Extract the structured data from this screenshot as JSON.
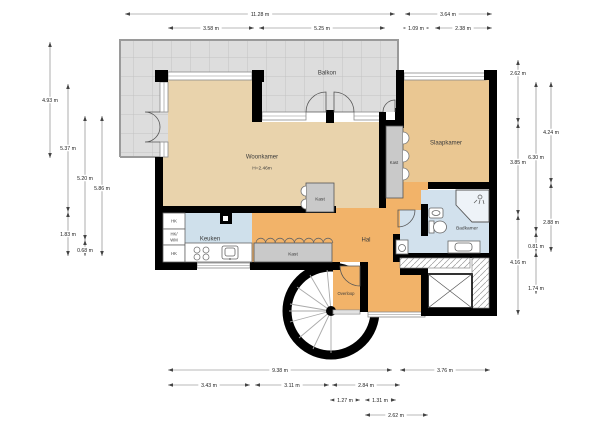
{
  "labels": {
    "balkon": "Balkon",
    "woonkamer": "Woonkamer",
    "woonkamer_height": "H=2.46m",
    "slaapkamer": "Slaapkamer",
    "badkamer": "Badkamer",
    "keuken": "Keuken",
    "hal": "Hal",
    "overloop": "Overloop",
    "kast_center": "Kast",
    "kast_wardrobe": "Kast",
    "kast_bedroom": "Kast",
    "hk_top": "HK",
    "hk_mid_1": "HK/",
    "hk_mid_2": "WM",
    "hk_bottom": "HK"
  },
  "colors": {
    "wall": "#000000",
    "living_room": "#e9d3ac",
    "bedroom": "#eac792",
    "hall": "#f2b369",
    "wet_room": "#d2e1ed",
    "balcony_tile": "#dddddd",
    "closet": "#c9c9c9",
    "dimension_line": "#777777"
  },
  "dimensions": [
    {
      "label": "11.28 m",
      "x1": 125,
      "y1": 14,
      "x2": 395,
      "y2": 14,
      "lx": 260,
      "ly": 14
    },
    {
      "label": "3.64 m",
      "x1": 405,
      "y1": 14,
      "x2": 492,
      "y2": 14,
      "lx": 448,
      "ly": 14
    },
    {
      "label": "3.58 m",
      "x1": 168,
      "y1": 28,
      "x2": 254,
      "y2": 28,
      "lx": 211,
      "ly": 28
    },
    {
      "label": "5.25 m",
      "x1": 259,
      "y1": 28,
      "x2": 385,
      "y2": 28,
      "lx": 322,
      "ly": 28
    },
    {
      "label": "1.09 m",
      "x1": 403,
      "y1": 28,
      "x2": 429,
      "y2": 28,
      "lx": 416,
      "ly": 28
    },
    {
      "label": "2.38 m",
      "x1": 435,
      "y1": 28,
      "x2": 492,
      "y2": 28,
      "lx": 463,
      "ly": 28
    },
    {
      "label": "4.93 m",
      "x1": 50,
      "y1": 42,
      "x2": 50,
      "y2": 158,
      "lx": 50,
      "ly": 100
    },
    {
      "label": "5.37 m",
      "x1": 68,
      "y1": 84,
      "x2": 68,
      "y2": 212,
      "lx": 68,
      "ly": 148
    },
    {
      "label": "1.83 m",
      "x1": 68,
      "y1": 212,
      "x2": 68,
      "y2": 256,
      "lx": 68,
      "ly": 234
    },
    {
      "label": "5.20 m",
      "x1": 85,
      "y1": 116,
      "x2": 85,
      "y2": 240,
      "lx": 85,
      "ly": 178
    },
    {
      "label": "0.68 m",
      "x1": 85,
      "y1": 240,
      "x2": 85,
      "y2": 256,
      "lx": 85,
      "ly": 250
    },
    {
      "label": "5.86 m",
      "x1": 102,
      "y1": 116,
      "x2": 102,
      "y2": 256,
      "lx": 102,
      "ly": 188
    },
    {
      "label": "2.62 m",
      "x1": 518,
      "y1": 60,
      "x2": 518,
      "y2": 123,
      "lx": 518,
      "ly": 73
    },
    {
      "label": "3.85 m",
      "x1": 518,
      "y1": 123,
      "x2": 518,
      "y2": 215,
      "lx": 518,
      "ly": 162
    },
    {
      "label": "4.16 m",
      "x1": 518,
      "y1": 215,
      "x2": 518,
      "y2": 315,
      "lx": 518,
      "ly": 262
    },
    {
      "label": "6.30 m",
      "x1": 536,
      "y1": 82,
      "x2": 536,
      "y2": 232,
      "lx": 536,
      "ly": 157
    },
    {
      "label": "0.81 m",
      "x1": 536,
      "y1": 232,
      "x2": 536,
      "y2": 252,
      "lx": 536,
      "ly": 246
    },
    {
      "label": "1.74 m",
      "x1": 536,
      "y1": 252,
      "x2": 536,
      "y2": 294,
      "lx": 536,
      "ly": 288
    },
    {
      "label": "4.24 m",
      "x1": 551,
      "y1": 82,
      "x2": 551,
      "y2": 183,
      "lx": 551,
      "ly": 132
    },
    {
      "label": "2.88 m",
      "x1": 551,
      "y1": 183,
      "x2": 551,
      "y2": 252,
      "lx": 551,
      "ly": 222
    },
    {
      "label": "9.38 m",
      "x1": 168,
      "y1": 370,
      "x2": 392,
      "y2": 370,
      "lx": 280,
      "ly": 370
    },
    {
      "label": "3.76 m",
      "x1": 400,
      "y1": 370,
      "x2": 490,
      "y2": 370,
      "lx": 445,
      "ly": 370
    },
    {
      "label": "3.43 m",
      "x1": 168,
      "y1": 385,
      "x2": 250,
      "y2": 385,
      "lx": 209,
      "ly": 385
    },
    {
      "label": "3.11 m",
      "x1": 255,
      "y1": 385,
      "x2": 329,
      "y2": 385,
      "lx": 292,
      "ly": 385
    },
    {
      "label": "2.84 m",
      "x1": 332,
      "y1": 385,
      "x2": 400,
      "y2": 385,
      "lx": 366,
      "ly": 385
    },
    {
      "label": "1.27 m",
      "x1": 330,
      "y1": 400,
      "x2": 360,
      "y2": 400,
      "lx": 345,
      "ly": 400
    },
    {
      "label": "1.31 m",
      "x1": 365,
      "y1": 400,
      "x2": 396,
      "y2": 400,
      "lx": 380,
      "ly": 400
    },
    {
      "label": "2.62 m",
      "x1": 365,
      "y1": 415,
      "x2": 428,
      "y2": 415,
      "lx": 396,
      "ly": 415
    }
  ]
}
